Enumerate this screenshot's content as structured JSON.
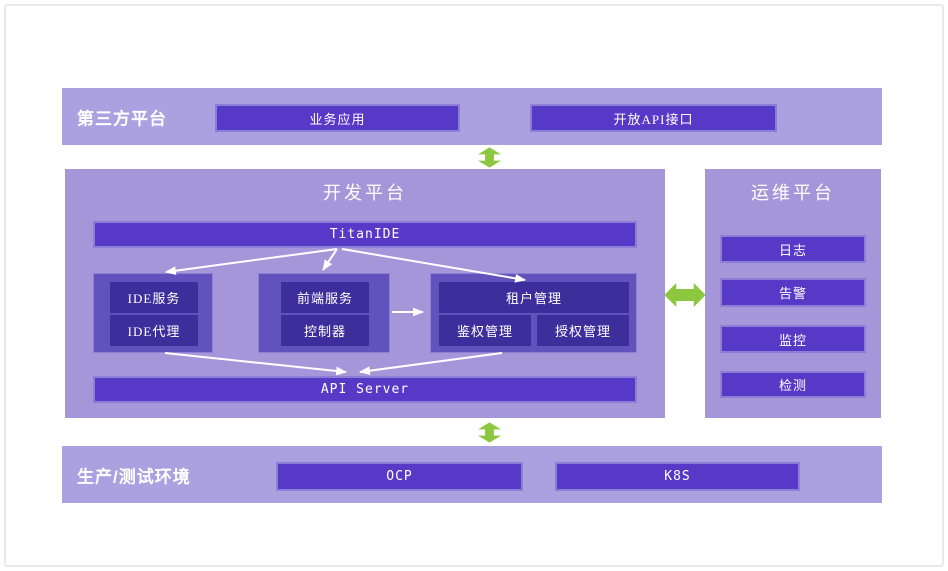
{
  "colors": {
    "band_bg": "#aca1e0",
    "panel_bg": "#a596da",
    "box_bg": "#5639c6",
    "box_border": "#8a7ed6",
    "group_bg": "#6152bd",
    "inner_box_bg": "#3e2e9c",
    "arrow_green": "#8dc63f",
    "connector_white": "#ffffff",
    "text": "#ffffff"
  },
  "third_party": {
    "title": "第三方平台",
    "boxes": [
      {
        "label": "业务应用"
      },
      {
        "label": "开放API接口"
      }
    ]
  },
  "dev_platform": {
    "title": "开发平台",
    "titan_ide": "TitanIDE",
    "api_server": "API Server",
    "ide_group": {
      "items": [
        {
          "label": "IDE服务"
        },
        {
          "label": "IDE代理"
        }
      ]
    },
    "frontend_group": {
      "items": [
        {
          "label": "前端服务"
        },
        {
          "label": "控制器"
        }
      ]
    },
    "tenant_group": {
      "title": "租户管理",
      "items": [
        {
          "label": "鉴权管理"
        },
        {
          "label": "授权管理"
        }
      ]
    }
  },
  "ops_platform": {
    "title": "运维平台",
    "boxes": [
      {
        "label": "日志"
      },
      {
        "label": "告警"
      },
      {
        "label": "监控"
      },
      {
        "label": "检测"
      }
    ]
  },
  "production": {
    "title": "生产/测试环境",
    "boxes": [
      {
        "label": "OCP"
      },
      {
        "label": "K8S"
      }
    ]
  }
}
